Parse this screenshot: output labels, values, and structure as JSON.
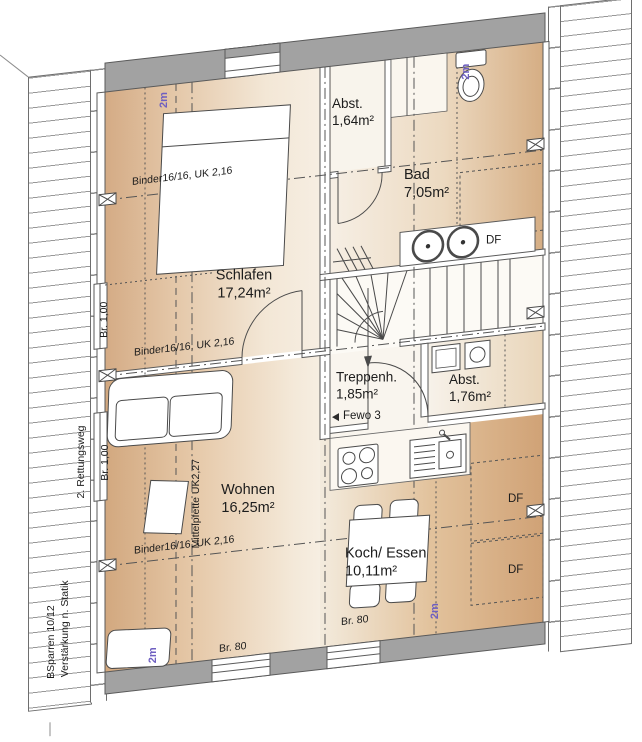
{
  "plan": {
    "rooms": [
      {
        "key": "schlafen",
        "name": "Schlafen",
        "area": "17,24m²"
      },
      {
        "key": "abstellraum_klein",
        "name": "Abst.",
        "area": "1,64m²"
      },
      {
        "key": "bad",
        "name": "Bad",
        "area": "7,05m²"
      },
      {
        "key": "treppenhaus",
        "name": "Treppenh.",
        "area": "1,85m²"
      },
      {
        "key": "abstellraum_flur",
        "name": "Abst.",
        "area": "1,76m²"
      },
      {
        "key": "wohnen",
        "name": "Wohnen",
        "area": "16,25m²"
      },
      {
        "key": "koch_essen",
        "name": "Koch/ Essen",
        "area": "10,11m²"
      }
    ],
    "annotations": {
      "binder_beam": "Binder16/16, UK 2,16",
      "middle_purlin": "Mittelpfette UK2,27",
      "opening_width_100": "Br. 1,00",
      "opening_width_80": "Br. 80",
      "escape_route": "2. Rettungsweg",
      "rafters_note": "BSparren 10/12",
      "reinforcement_note": "Verstärkung n. Statik",
      "apartment_label": "Fewo 3",
      "roof_window_abbr": "DF",
      "headroom_mark": "2m"
    },
    "colors": {
      "wall_gray": "#a2a2a2",
      "line_dark": "#4a4a4a",
      "floor_tan": "#d8ae85",
      "floor_light": "#f6efe4",
      "headroom_purple": "#6e5fc1"
    }
  }
}
